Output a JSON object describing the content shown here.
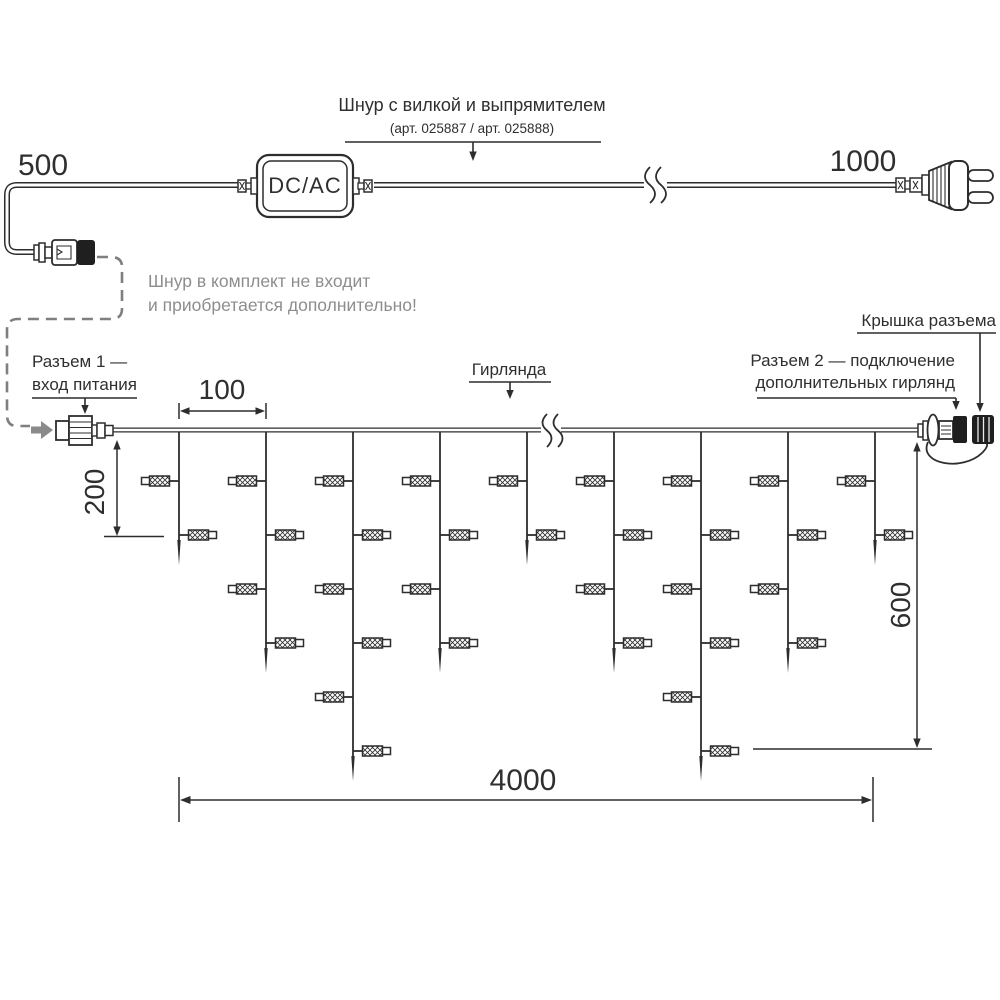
{
  "diagram": {
    "power_cord": {
      "label_line1": "Шнур с вилкой и выпрямителем",
      "label_line2": "(арт. 025887 / арт. 025888)",
      "converter_text": "DC/AC",
      "left_length": "500",
      "right_length": "1000"
    },
    "note": {
      "line1": "Шнур в комплект не входит",
      "line2": "и приобретается дополнительно!"
    },
    "callouts": {
      "connector1_line1": "Разъем 1 —",
      "connector1_line2": "вход питания",
      "garland": "Гирлянда",
      "connector2_line1": "Разъем 2 — подключение",
      "connector2_line2": "дополнительных гирлянд",
      "cap": "Крышка разъема"
    },
    "dimensions": {
      "drop_pitch": "100",
      "first_drop": "200",
      "max_drop": "600",
      "length": "4000"
    },
    "garland": {
      "wire_y": 430,
      "first_lamp_y": 481,
      "lamp_spacing": 54,
      "tip_extra": 30,
      "strand_xs": [
        179,
        266,
        353,
        440,
        527,
        614,
        701,
        788,
        875
      ],
      "lamp_counts": [
        2,
        4,
        6,
        4,
        2,
        4,
        6,
        4,
        2
      ]
    },
    "colors": {
      "line": "#2d2d2d",
      "note_text": "#8d8d8d",
      "dash": "#7f7f7f",
      "cap_fill": "#1f1f1f"
    }
  }
}
